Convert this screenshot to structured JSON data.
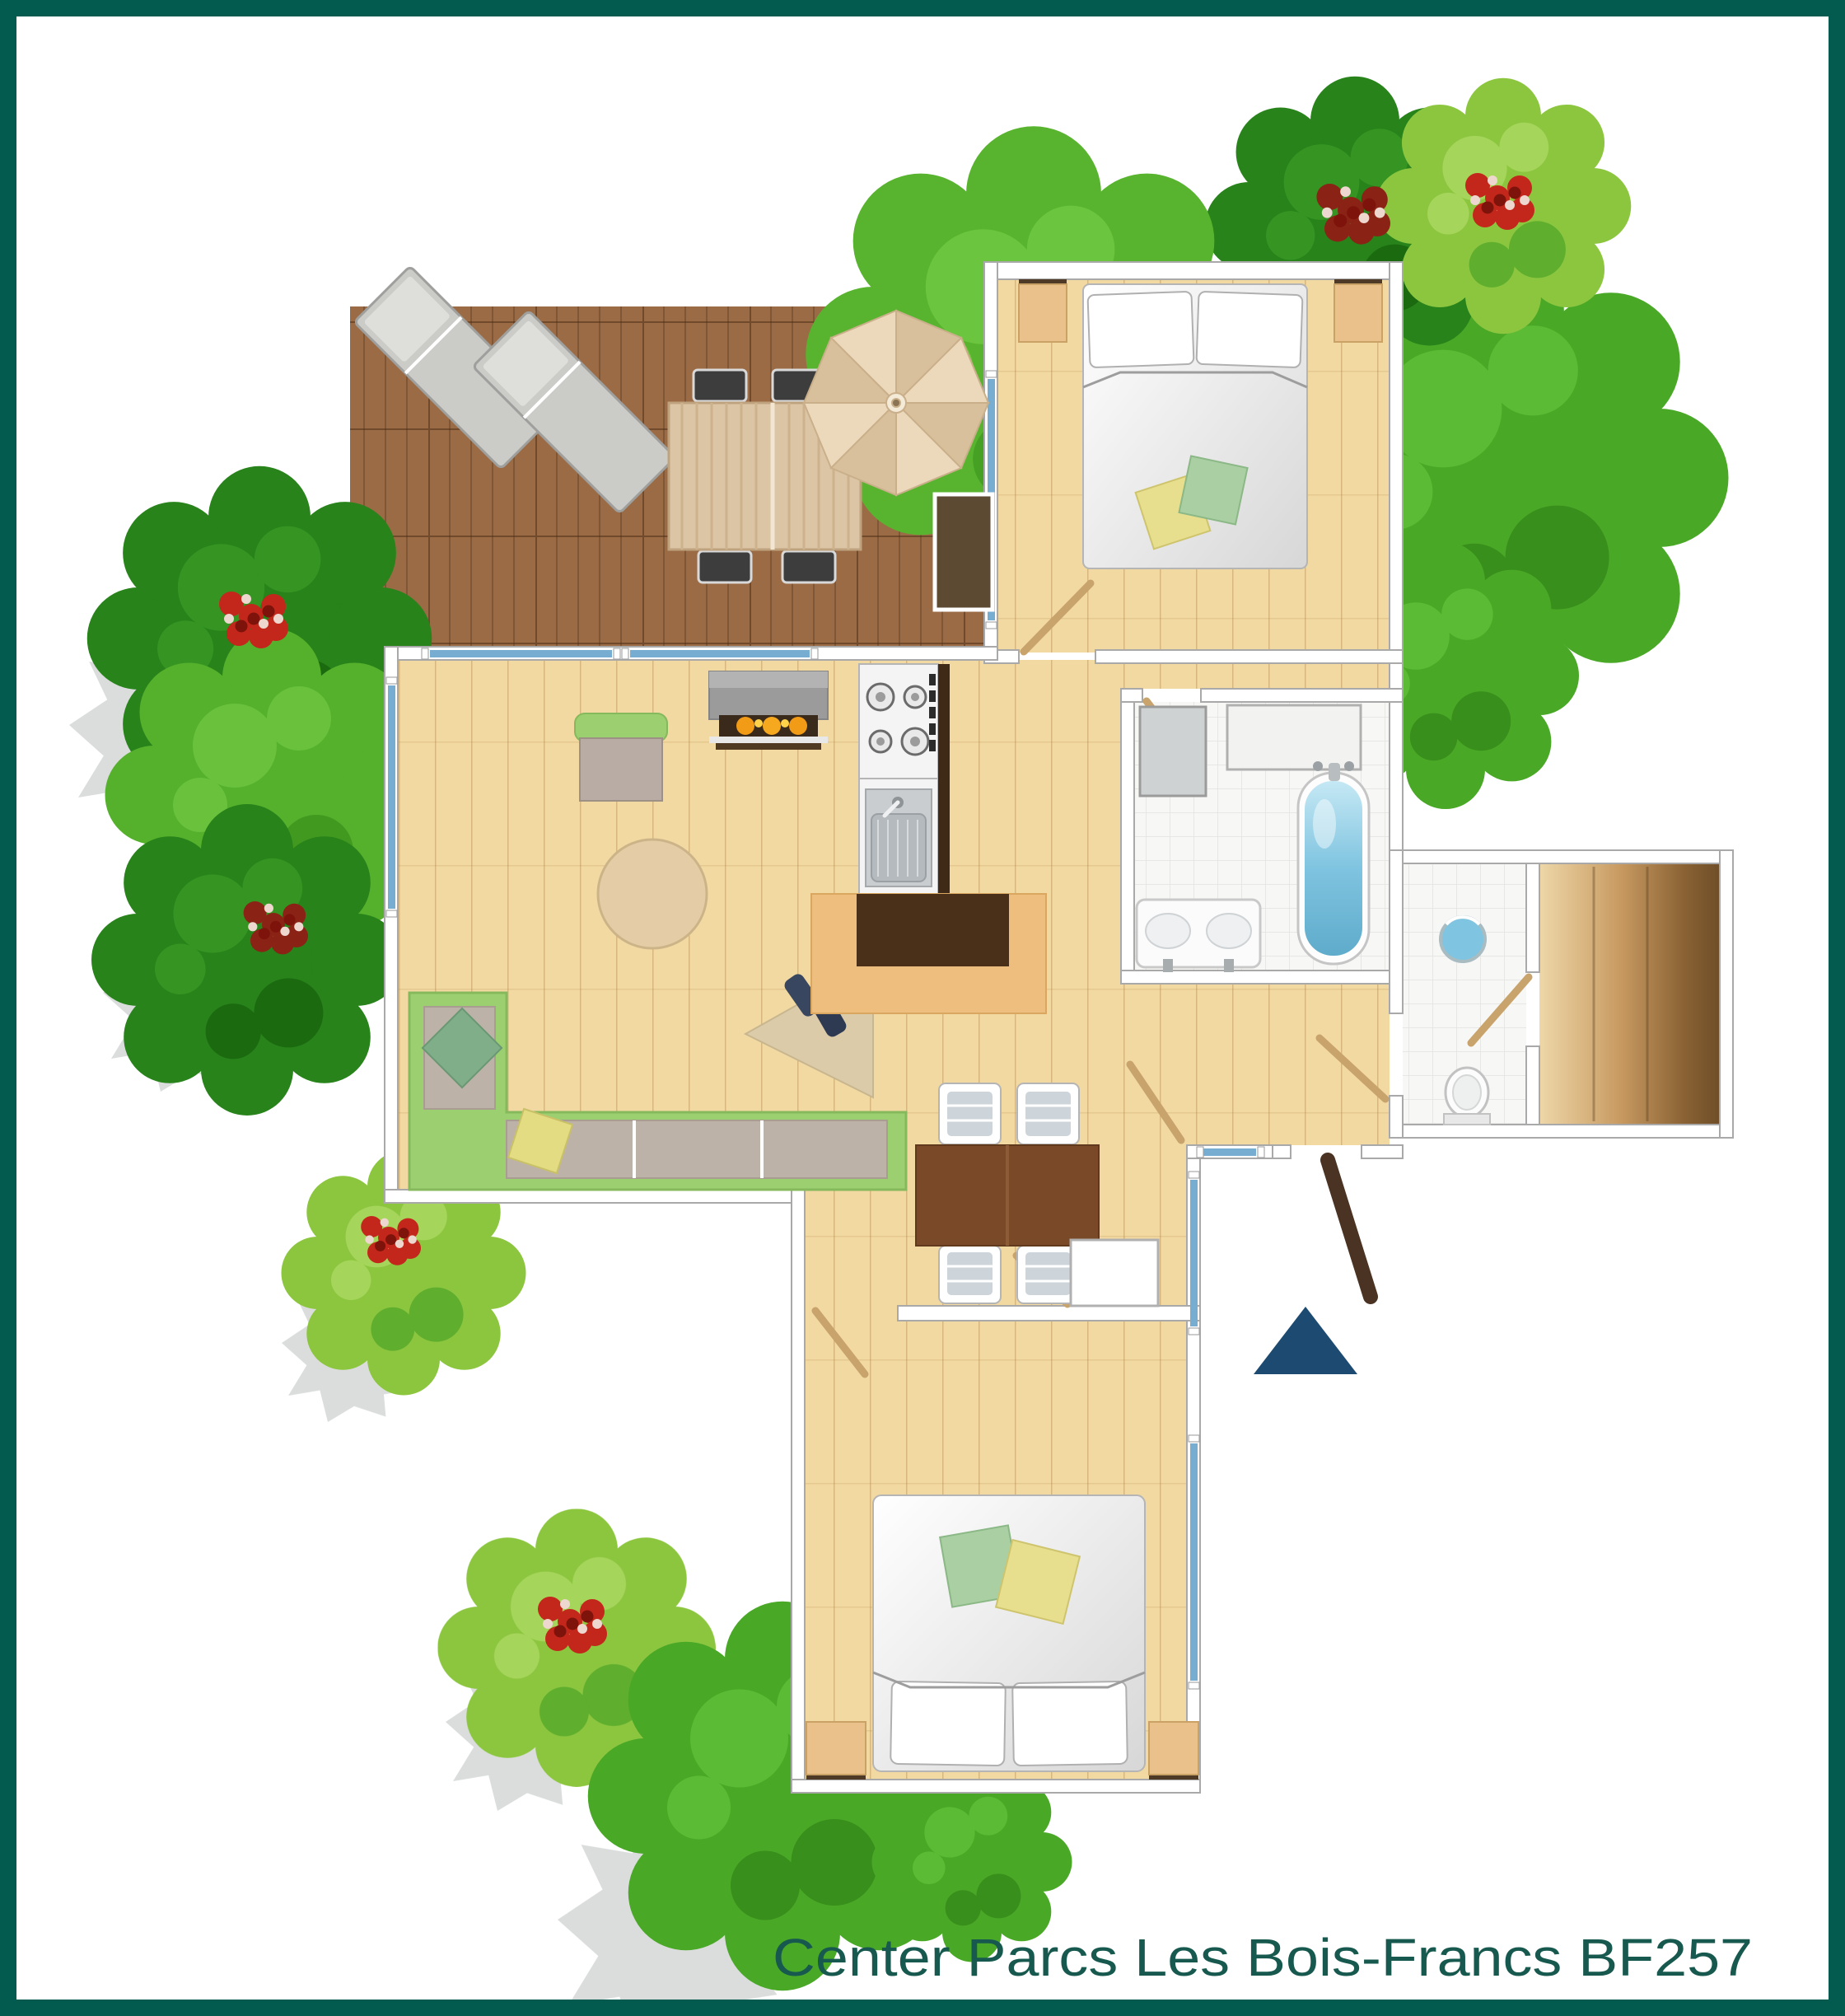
{
  "caption": {
    "text": "Center Parcs Les Bois-Francs BF257"
  },
  "palette": {
    "frame": "#035b4f",
    "caption": "#17594e",
    "floor": "#f2d9a2",
    "deck": "#9a6b45",
    "wall": "#ffffff",
    "wall_line": "#a9a9a9",
    "window": "#76add0",
    "water": "#7fc4e0",
    "tile": "#f7f7f5",
    "sofa": "#9ccf6f",
    "tree_dark": "#27831a",
    "tree_bright": "#4aa827",
    "tree_light": "#8cc63f",
    "flower": "#c3271c",
    "door": "#c8a36b",
    "entry_door": "#4a3322",
    "arrow": "#1d4a70",
    "counter": "#4a3018",
    "counter_edge": "#edbe7d",
    "fireplace_glow": "#f29b16"
  },
  "plan_objects": [
    "wooden-deck",
    "sun-loungers",
    "patio-table",
    "patio-chairs",
    "parasol",
    "bedroom-double-bed",
    "nightstands",
    "deck-storage-box",
    "fireplace",
    "armchair",
    "corner-sofa",
    "round-rug",
    "kitchenette-hob",
    "kitchenette-sink",
    "kitchen-counter",
    "doormat-with-boots",
    "dining-table",
    "dining-chairs",
    "wardrobe",
    "washing-machine",
    "bathtub",
    "double-washbasin",
    "hand-basin",
    "toilet",
    "sauna",
    "second-double-bed",
    "entrance-marker",
    "trees",
    "flowering-shrubs",
    "tree-shadows"
  ]
}
